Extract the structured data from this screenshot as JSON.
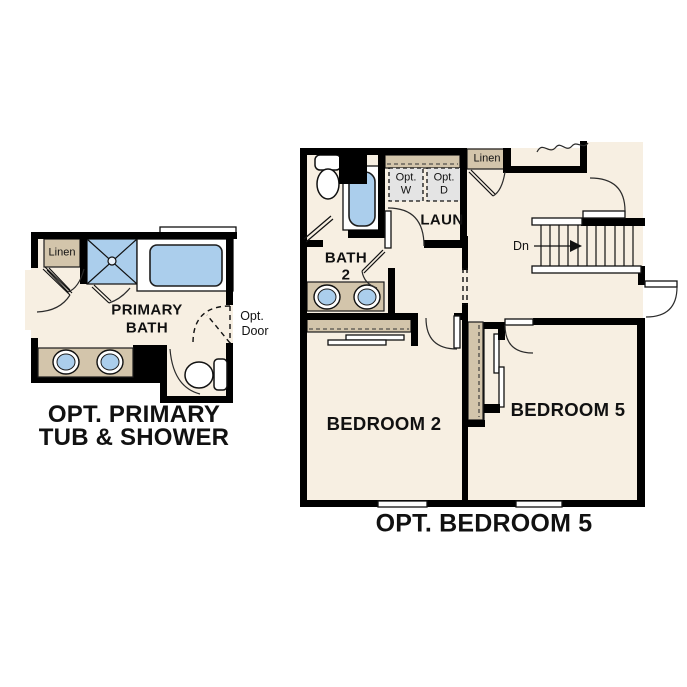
{
  "colors": {
    "wall": "#000000",
    "cream": "#f7efe2",
    "tan": "#d3c5ab",
    "blue": "#abceec",
    "gray": "#e4e4e4",
    "text": "#111111",
    "bg": "#ffffff"
  },
  "left_plan": {
    "title_line1": "OPT. PRIMARY",
    "title_line2": "TUB & SHOWER",
    "linen_label": "Linen",
    "room_label_line1": "PRIMARY",
    "room_label_line2": "BATH",
    "opt_door_line1": "Opt.",
    "opt_door_line2": "Door"
  },
  "right_plan": {
    "title": "OPT. BEDROOM 5",
    "bath_label_line1": "BATH",
    "bath_label_line2": "2",
    "laundry_label": "LAUN",
    "washer_line1": "Opt.",
    "washer_line2": "W",
    "dryer_line1": "Opt.",
    "dryer_line2": "D",
    "linen_label": "Linen",
    "stairs_label": "Dn",
    "bedroom2_label": "BEDROOM 2",
    "bedroom5_label": "BEDROOM 5"
  }
}
